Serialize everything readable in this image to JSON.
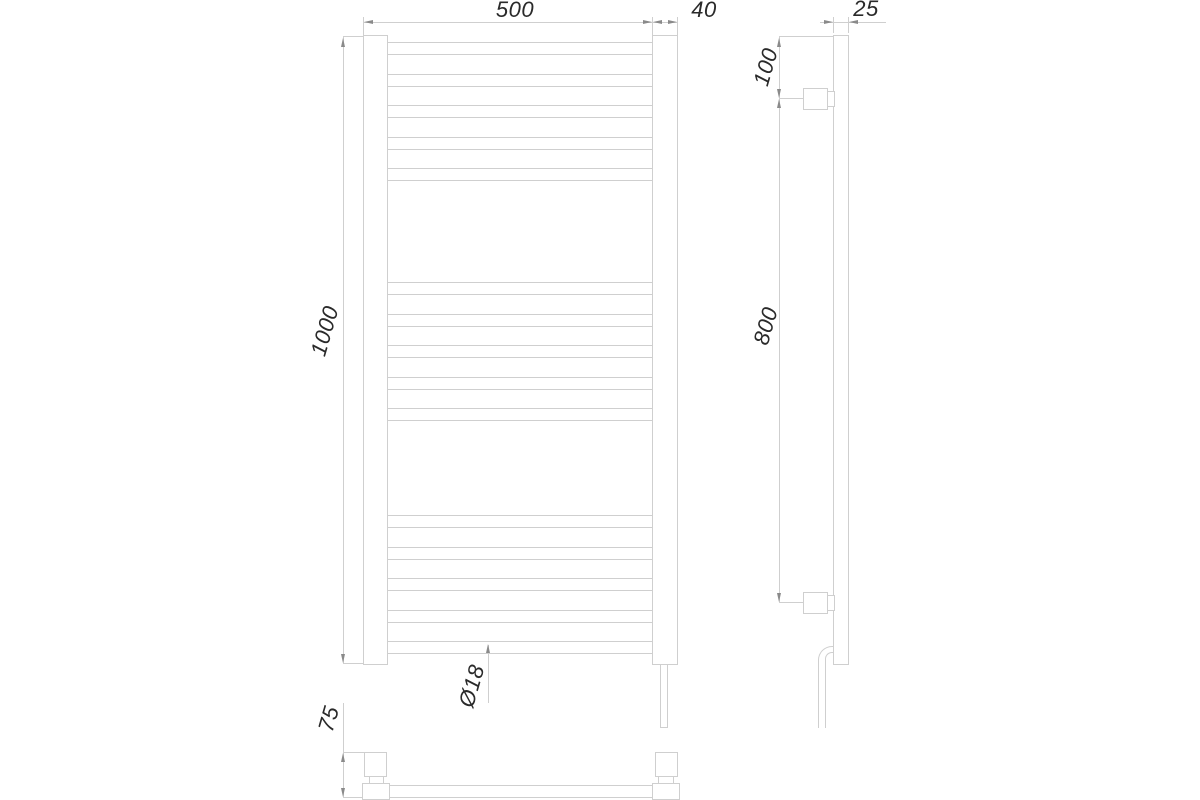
{
  "drawing": {
    "type": "technical dimension drawing",
    "subject": "ladder heated towel rail, three views (front, side, plan)"
  },
  "dims": {
    "overall_width": "500",
    "collector_width": "40",
    "profile_depth": "25",
    "overall_height": "1000",
    "top_bracket_offset": "100",
    "bracket_span": "800",
    "tube_diameter": "Ø18",
    "wall_offset": "75"
  },
  "front_view": {
    "tube_groups": 3,
    "tubes_per_group": 5
  },
  "colors": {
    "line": "#cfcfcf",
    "text": "#2a2a2a",
    "arrow": "#8a8a8a",
    "background": "#ffffff"
  }
}
